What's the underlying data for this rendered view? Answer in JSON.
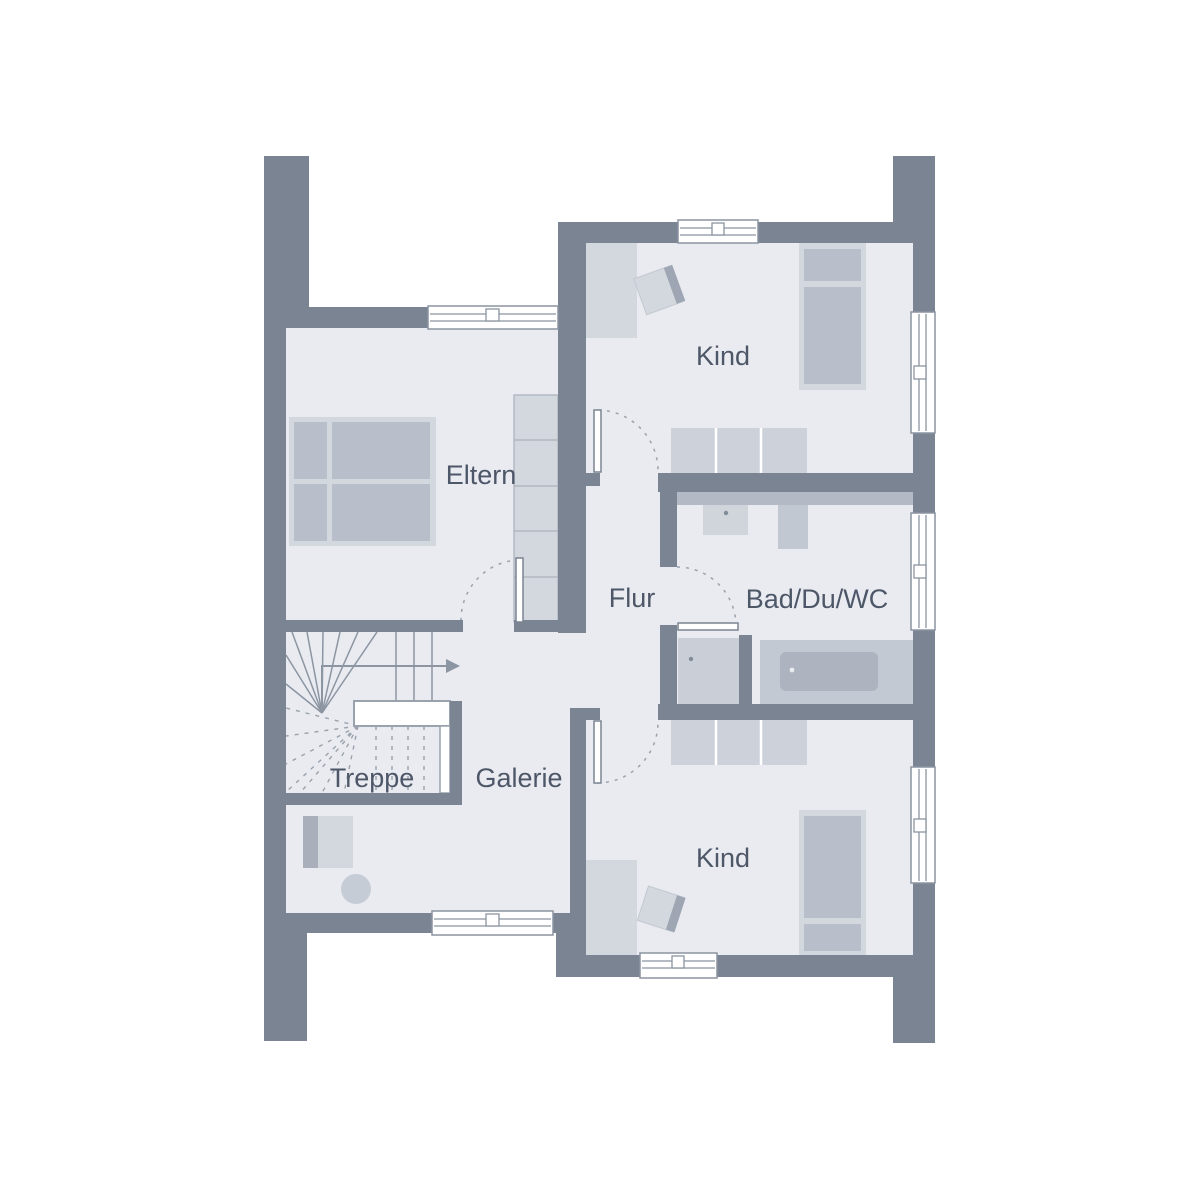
{
  "plan": {
    "type": "floor-plan",
    "floor": "upper-floor",
    "rooms": [
      {
        "name": "eltern",
        "label": "Eltern"
      },
      {
        "name": "kind-top",
        "label": "Kind"
      },
      {
        "name": "flur",
        "label": "Flur"
      },
      {
        "name": "bad-du-wc",
        "label": "Bad/Du/WC"
      },
      {
        "name": "treppe",
        "label": "Treppe"
      },
      {
        "name": "galerie",
        "label": "Galerie"
      },
      {
        "name": "kind-bottom",
        "label": "Kind"
      }
    ],
    "colors": {
      "wall": "#7b8492",
      "floor": "#e9ebf0",
      "furniture_light": "#d3d7de",
      "furniture_mid": "#b8bfca",
      "furniture_dark": "#9ea6b3",
      "counter": "#b3bac5",
      "label_text": "#4d5768",
      "background": "#ffffff",
      "stair_lines": "#8c95a2"
    }
  }
}
